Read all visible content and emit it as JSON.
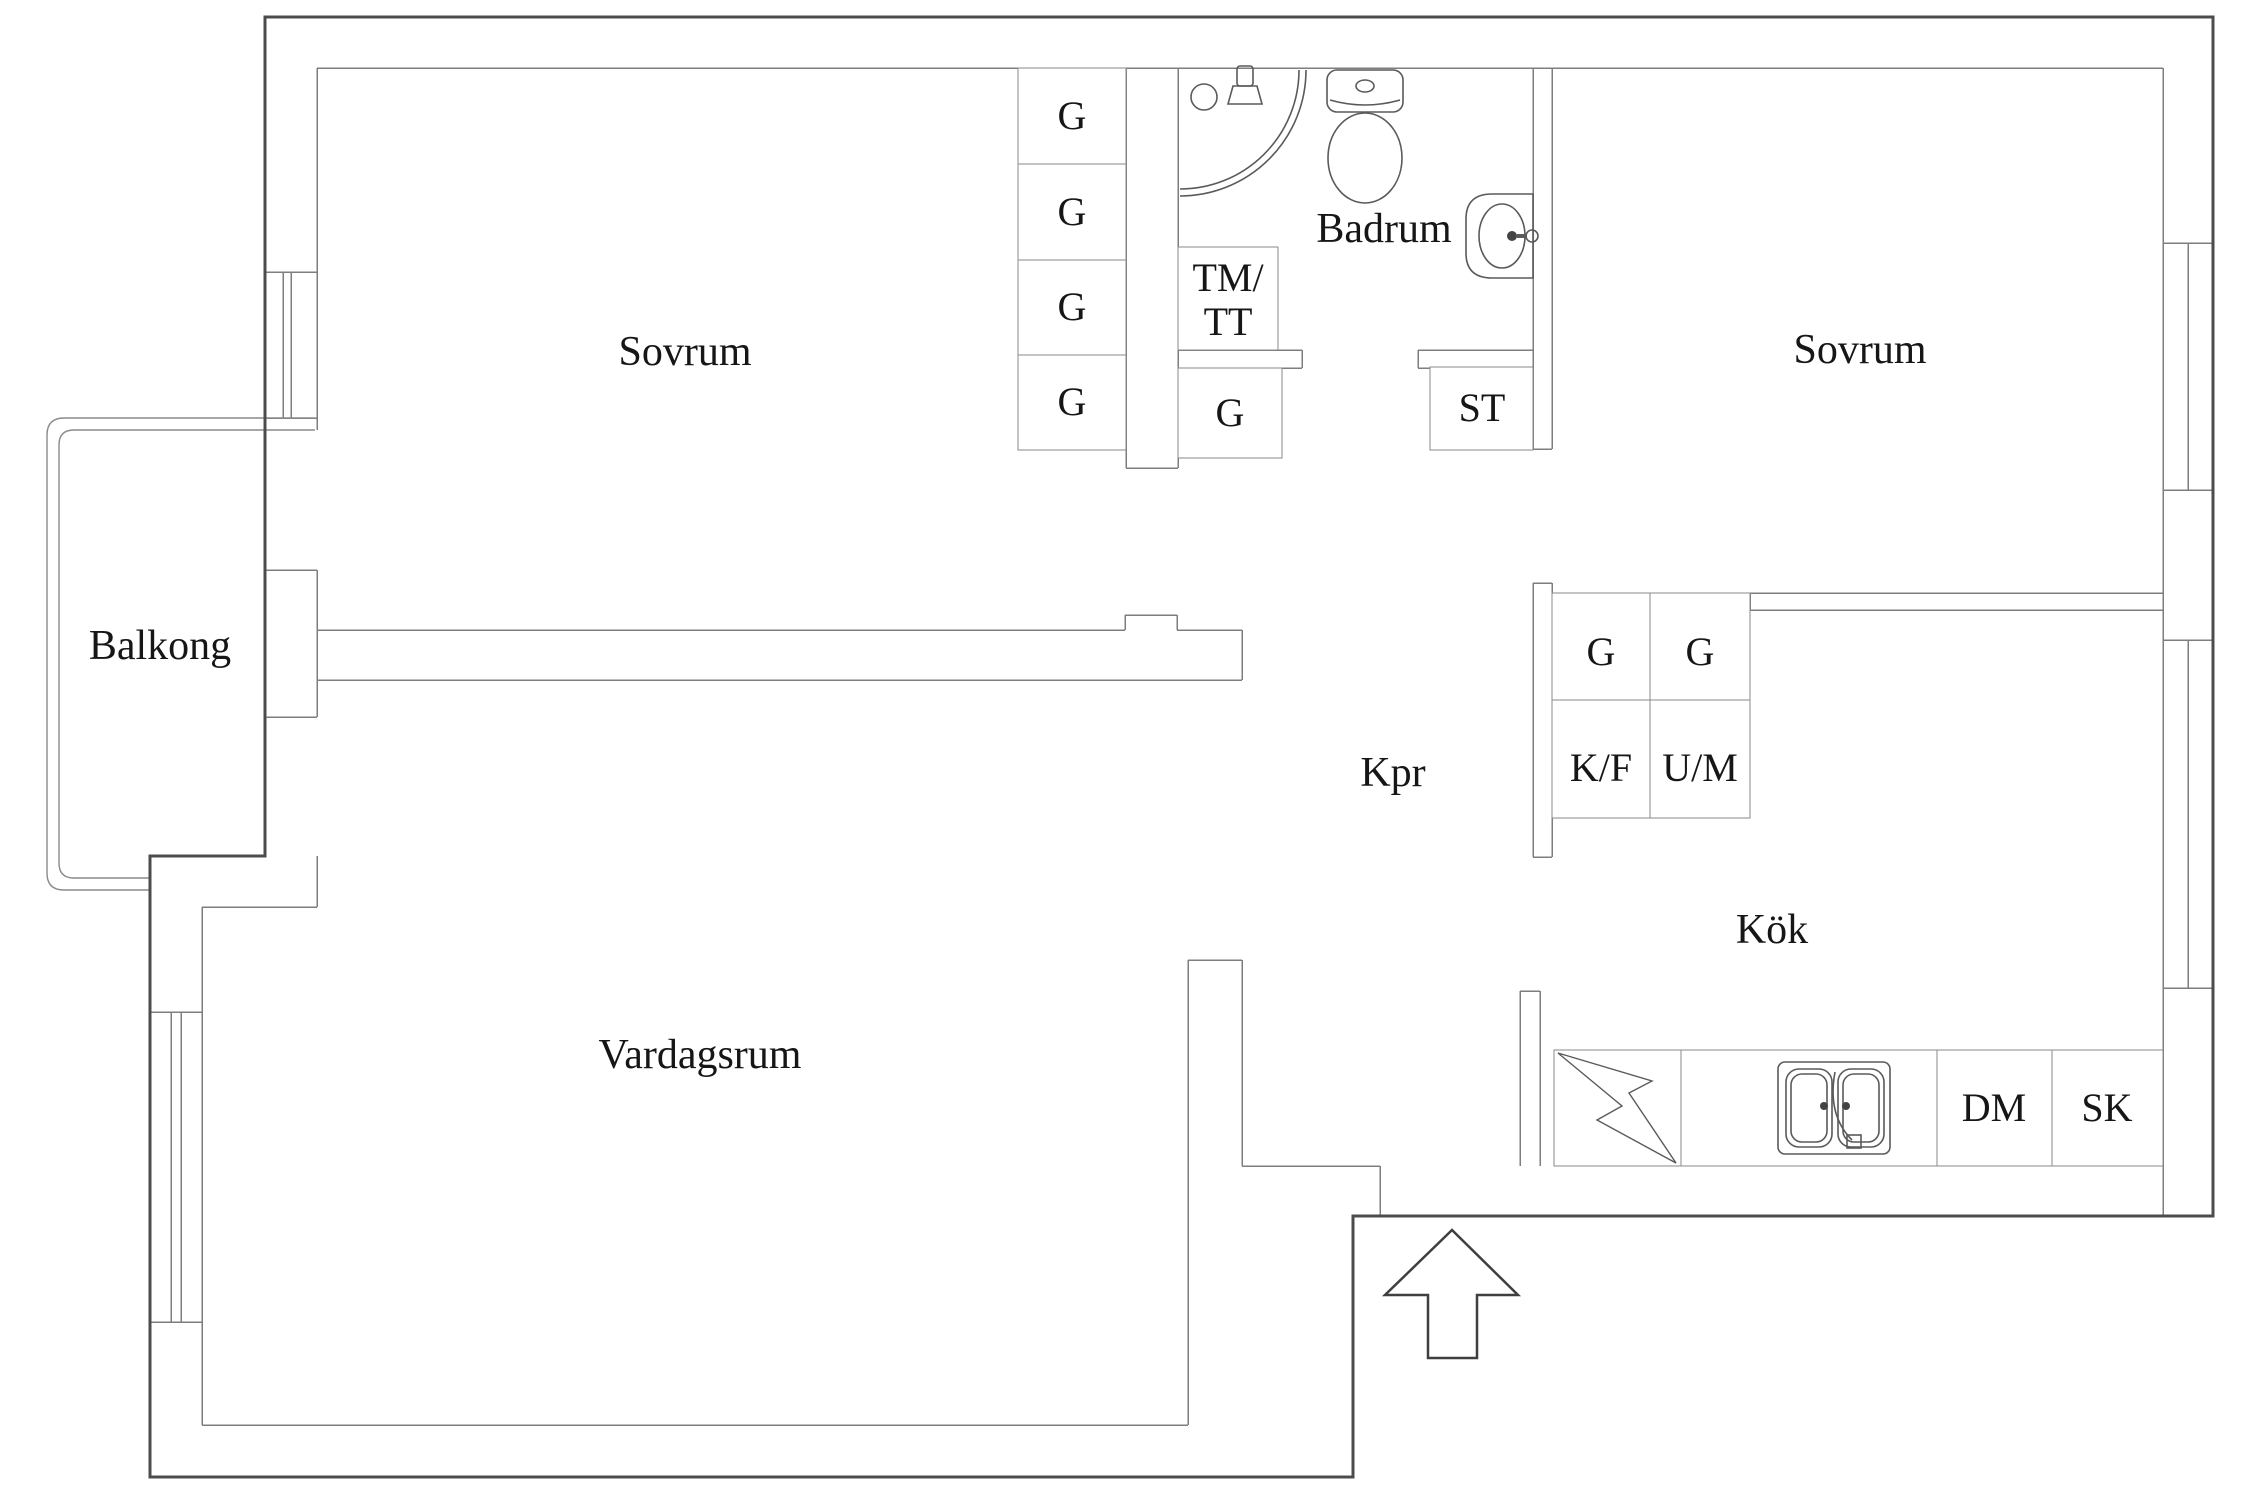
{
  "rooms": {
    "bedroom_left": "Sovrum",
    "bedroom_right": "Sovrum",
    "bathroom": "Badrum",
    "balcony": "Balkong",
    "living_room": "Vardagsrum",
    "kitchen": "Kök",
    "corridor": "Kpr"
  },
  "closets": {
    "bedroom_wardrobes": [
      "G",
      "G",
      "G",
      "G"
    ],
    "washer_dryer_line1": "TM/",
    "washer_dryer_line2": "TT",
    "hall_wardrobe": "G",
    "cleaning_closet": "ST",
    "hall_units": [
      "G",
      "G",
      "K/F",
      "U/M"
    ],
    "kitchen_dishwasher": "DM",
    "kitchen_cabinet": "SK"
  },
  "colors": {
    "outer_wall": "#4c4c4c",
    "inner_wall": "#7e7e7e",
    "fixture": "#5a5a5a",
    "text": "#161616"
  }
}
